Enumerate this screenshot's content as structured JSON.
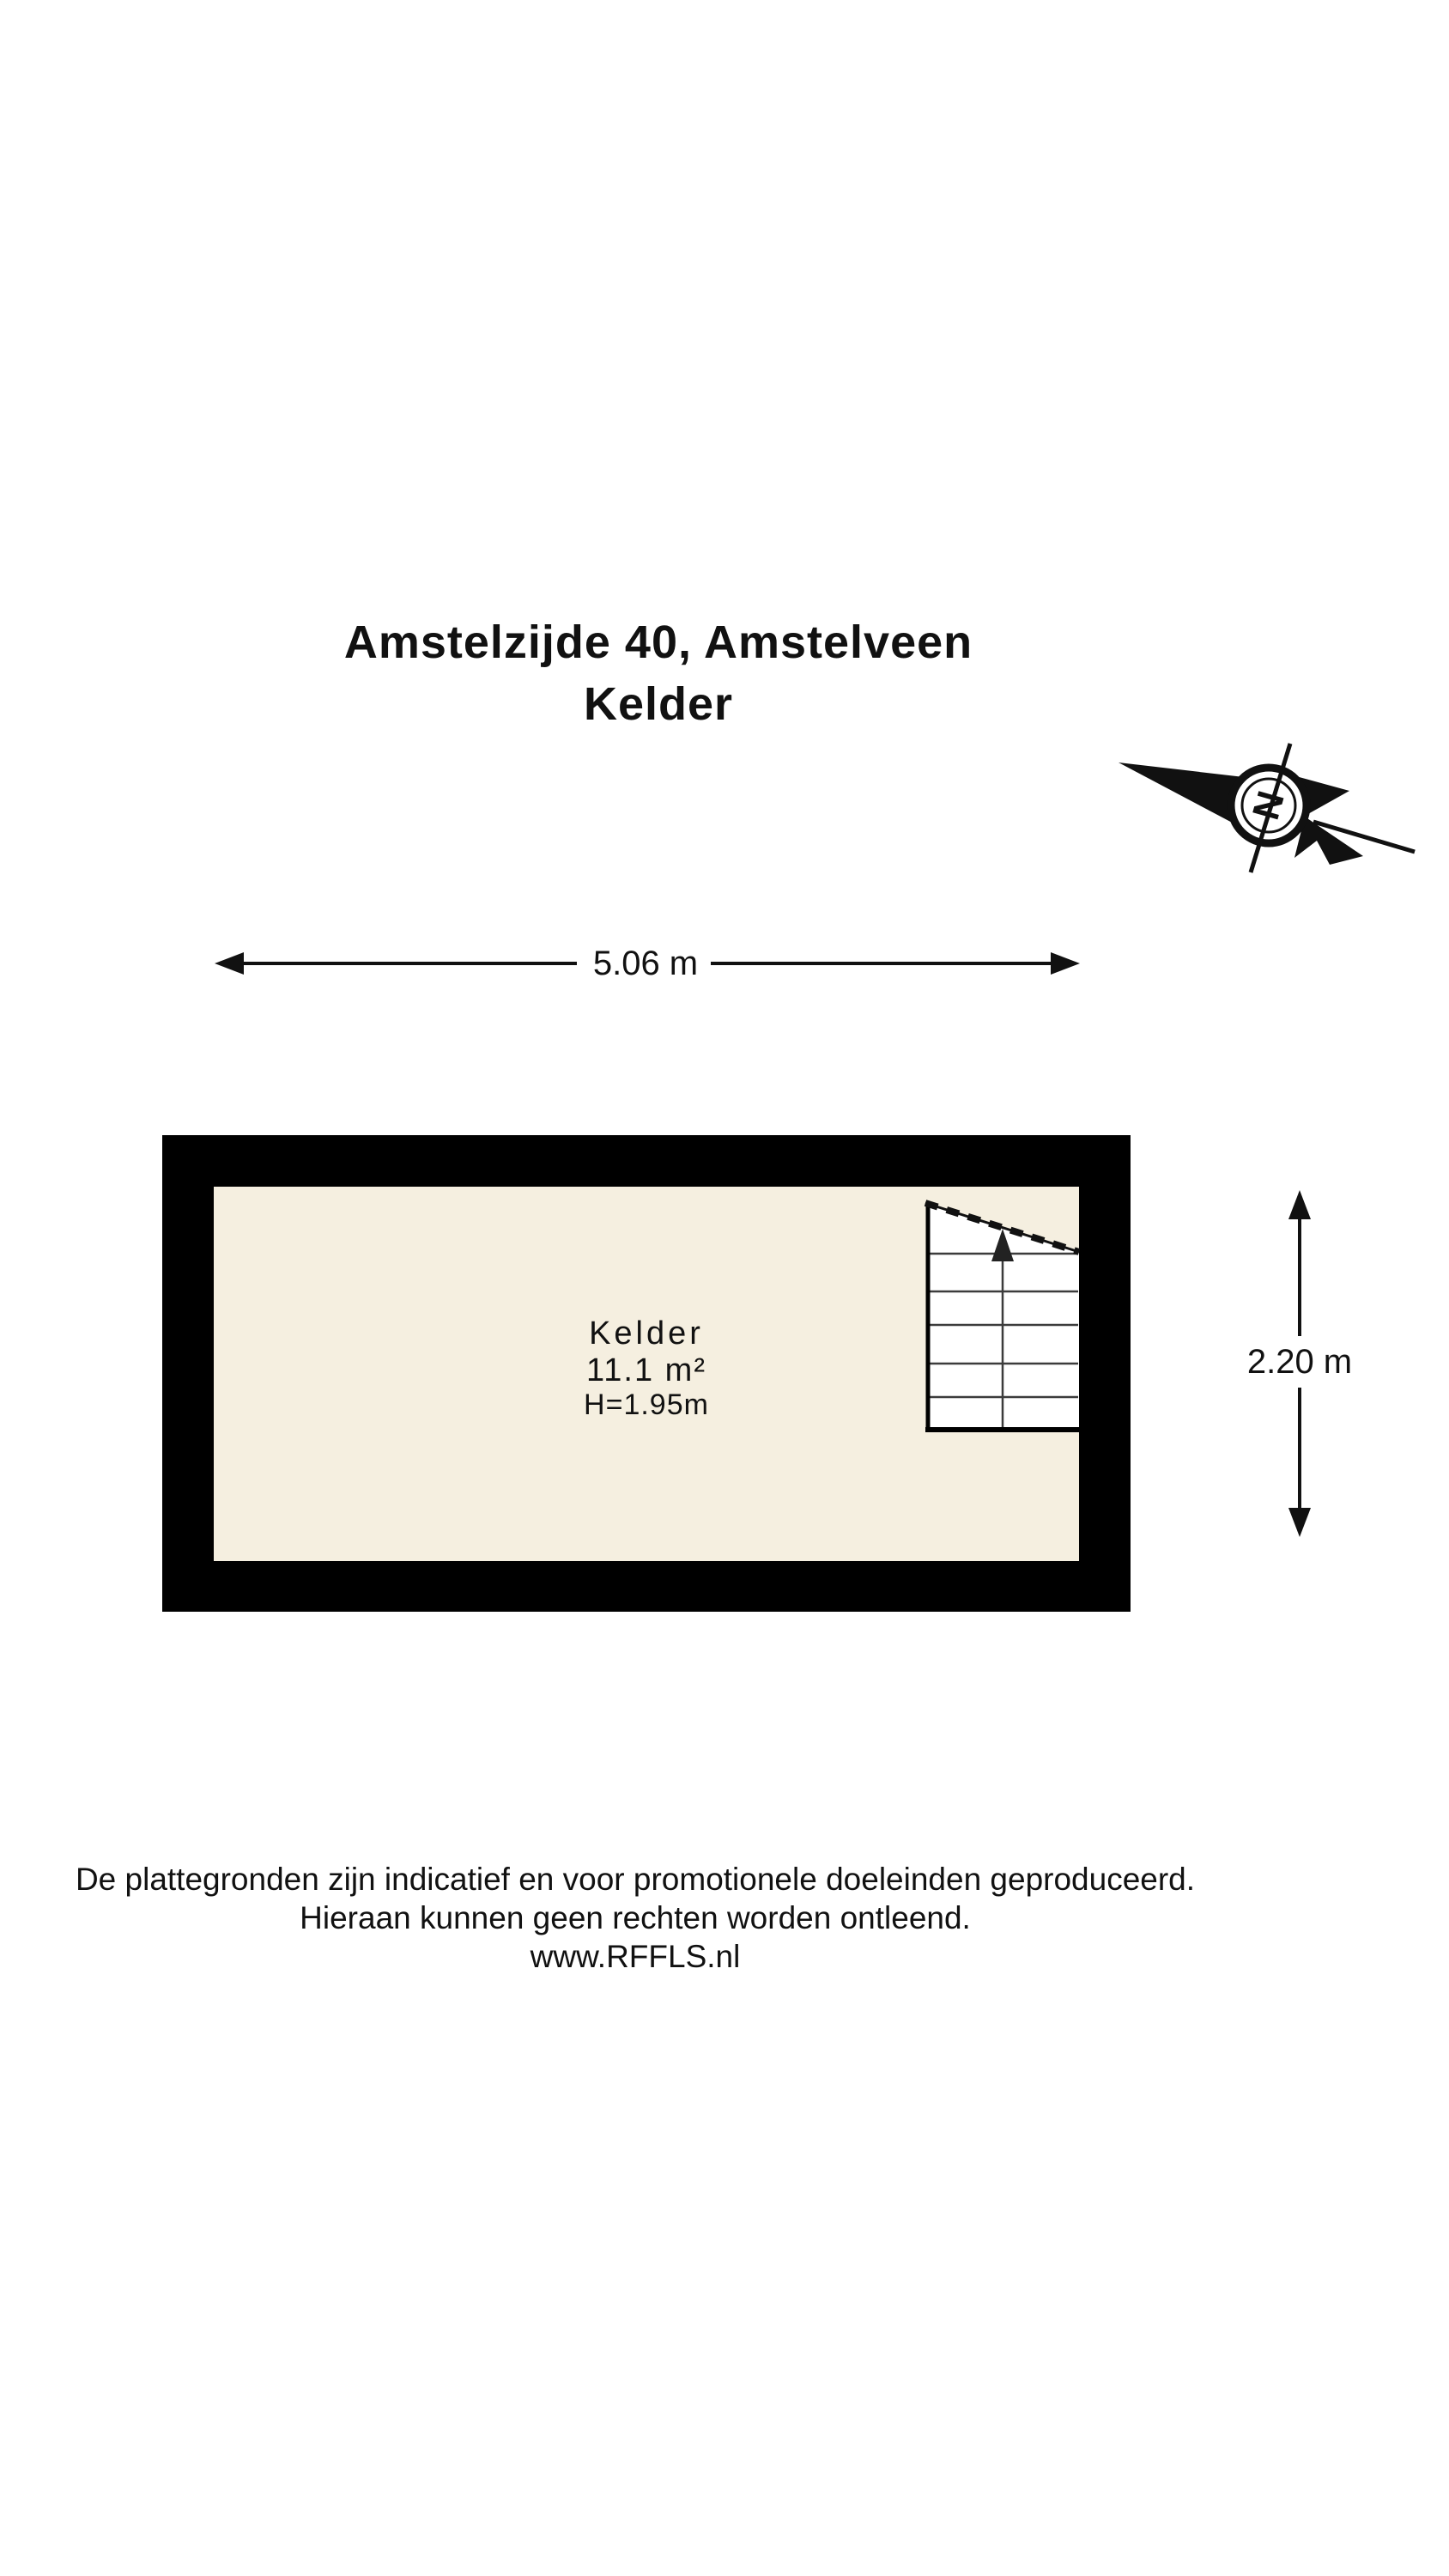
{
  "title": {
    "line1": "Amstelzijde 40, Amstelveen",
    "line2": "Kelder"
  },
  "compass": {
    "north_label": "N"
  },
  "dimensions": {
    "width_label": "5.06 m",
    "height_label": "2.20 m"
  },
  "room": {
    "name": "Kelder",
    "area": "11.1 m²",
    "ceiling_height": "H=1.95m"
  },
  "footer": {
    "line1": "De plattegronden zijn indicatief en voor promotionele doeleinden geproduceerd.",
    "line2": "Hieraan kunnen geen rechten worden ontleend.",
    "line3": "www.RFFLS.nl"
  },
  "colors": {
    "wall": "#000000",
    "floor": "#f5efe0",
    "stairs_fill": "#ffffff",
    "ink": "#111111"
  }
}
